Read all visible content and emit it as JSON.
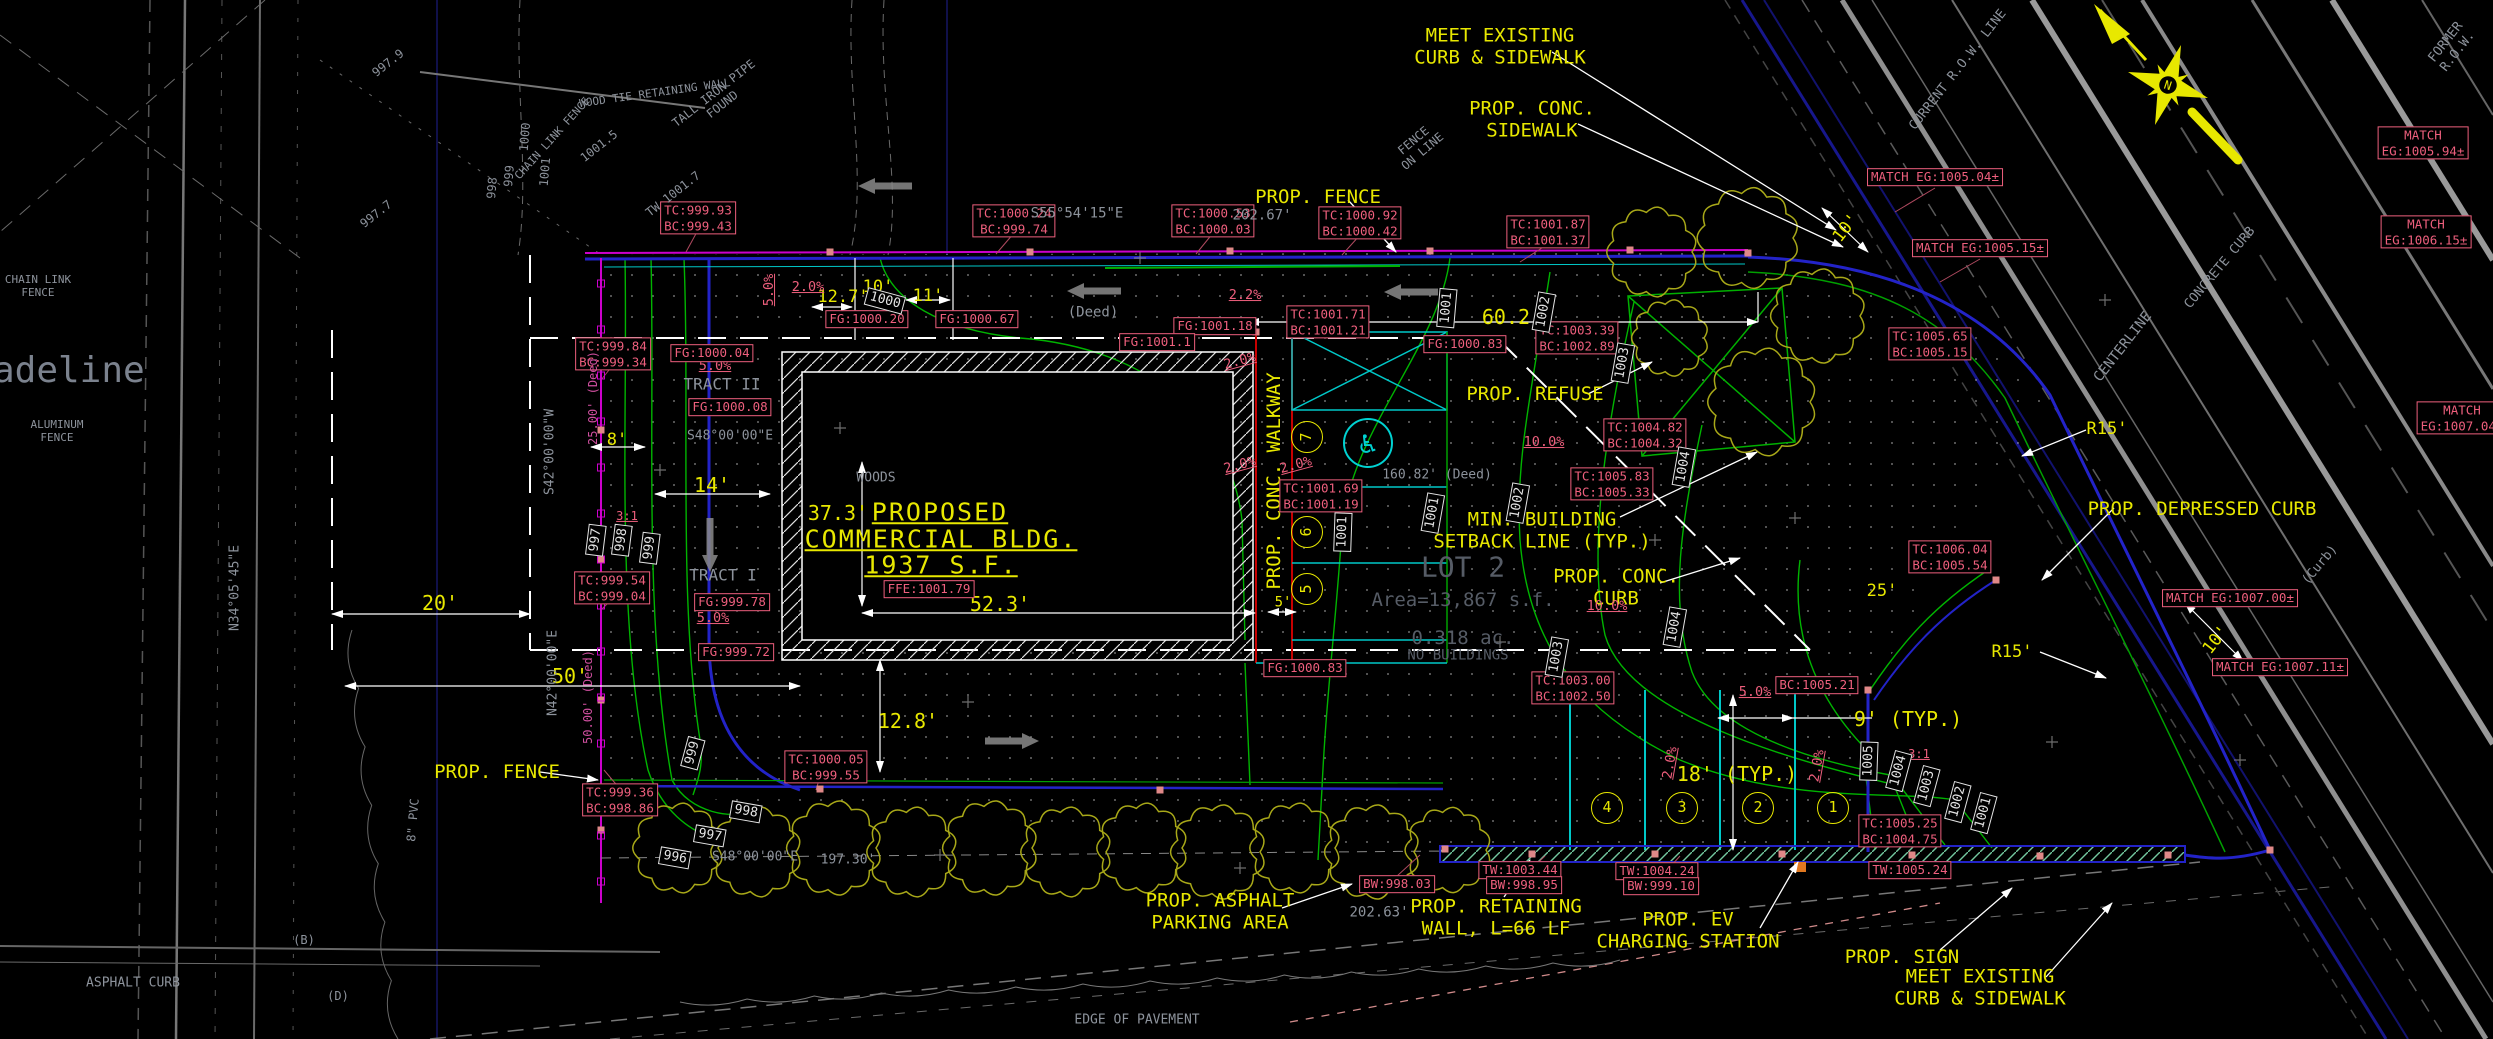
{
  "drawing": {
    "north": {
      "letter": "N"
    },
    "building_text": [
      {
        "t": "PROPOSED",
        "x": 940,
        "y": 512
      },
      {
        "t": "COMMERCIAL BLDG.",
        "x": 941,
        "y": 539
      },
      {
        "t": "1937 S.F.",
        "x": 941,
        "y": 565
      }
    ],
    "callouts": [
      {
        "t": "MEET EXISTING\nCURB & SIDEWALK",
        "x": 1500,
        "y": 47
      },
      {
        "t": "PROP. CONC.\nSIDEWALK",
        "x": 1532,
        "y": 120
      },
      {
        "t": "PROP. FENCE",
        "x": 1318,
        "y": 197
      },
      {
        "t": "PROP. REFUSE",
        "x": 1535,
        "y": 394
      },
      {
        "t": "MIN. BUILDING\nSETBACK LINE (TYP.)",
        "x": 1542,
        "y": 531
      },
      {
        "t": "PROP. CONC.\nCURB",
        "x": 1616,
        "y": 588
      },
      {
        "t": "PROP. DEPRESSED CURB",
        "x": 2202,
        "y": 509
      },
      {
        "t": "PROP. FENCE",
        "x": 497,
        "y": 772
      },
      {
        "t": "PROP. ASPHALT\nPARKING AREA",
        "x": 1220,
        "y": 912
      },
      {
        "t": "PROP. RETAINING\nWALL, L=66 LF",
        "x": 1496,
        "y": 918
      },
      {
        "t": "PROP. EV\nCHARGING STATION",
        "x": 1688,
        "y": 931
      },
      {
        "t": "PROP. SIGN",
        "x": 1902,
        "y": 957
      },
      {
        "t": "MEET EXISTING\nCURB & SIDEWALK",
        "x": 1980,
        "y": 988
      },
      {
        "t": "PROP. CONC. WALKWAY",
        "x": 1274,
        "y": 481,
        "r": -90
      }
    ],
    "dimensions": [
      {
        "t": "12.7'",
        "x": 843,
        "y": 297,
        "s": 17
      },
      {
        "t": "10'",
        "x": 878,
        "y": 287,
        "s": 17
      },
      {
        "t": "11'",
        "x": 928,
        "y": 296,
        "s": 17
      },
      {
        "t": "60.2'",
        "x": 1512,
        "y": 318
      },
      {
        "t": "37.3'",
        "x": 838,
        "y": 514
      },
      {
        "t": "52.3'",
        "x": 1000,
        "y": 605
      },
      {
        "t": "8'",
        "x": 617,
        "y": 440,
        "s": 17
      },
      {
        "t": "14'",
        "x": 712,
        "y": 486
      },
      {
        "t": "20'",
        "x": 440,
        "y": 604
      },
      {
        "t": "50'",
        "x": 570,
        "y": 677
      },
      {
        "t": "12.8'",
        "x": 908,
        "y": 722
      },
      {
        "t": "5'",
        "x": 1283,
        "y": 603,
        "s": 14
      },
      {
        "t": "18' (TYP.)",
        "x": 1737,
        "y": 775
      },
      {
        "t": "9' (TYP.)",
        "x": 1908,
        "y": 720
      },
      {
        "t": "25'",
        "x": 1882,
        "y": 591,
        "s": 17
      },
      {
        "t": "10'",
        "x": 2216,
        "y": 640,
        "r": -52,
        "s": 17
      },
      {
        "t": "10'",
        "x": 1846,
        "y": 228,
        "r": -52,
        "s": 17
      },
      {
        "t": "R15'",
        "x": 2107,
        "y": 429,
        "s": 17
      },
      {
        "t": "R15'",
        "x": 2012,
        "y": 652,
        "s": 17
      }
    ],
    "slopes": [
      {
        "t": "5.0%",
        "x": 770,
        "y": 290,
        "r": -90
      },
      {
        "t": "2.0%",
        "x": 808,
        "y": 288
      },
      {
        "t": "2.2%",
        "x": 1245,
        "y": 296
      },
      {
        "t": "5.0%",
        "x": 715,
        "y": 367
      },
      {
        "t": "5.0%",
        "x": 713,
        "y": 619
      },
      {
        "t": "10.0%",
        "x": 1544,
        "y": 443
      },
      {
        "t": "10.0%",
        "x": 1607,
        "y": 607
      },
      {
        "t": "5.0%",
        "x": 1755,
        "y": 693
      },
      {
        "t": "2.0%",
        "x": 1671,
        "y": 763,
        "r": -80
      },
      {
        "t": "2.0%",
        "x": 1818,
        "y": 766,
        "r": -80
      },
      {
        "t": "2.0%",
        "x": 1240,
        "y": 362,
        "r": -15
      },
      {
        "t": "2.0%",
        "x": 1240,
        "y": 466,
        "r": -15
      },
      {
        "t": "2.0%",
        "x": 1296,
        "y": 466,
        "r": -15
      },
      {
        "t": "3:1",
        "x": 627,
        "y": 516,
        "s": 12
      },
      {
        "t": "3:1",
        "x": 1919,
        "y": 754,
        "s": 12
      }
    ],
    "elevations": [
      {
        "t": "TC:999.93\nBC:999.43",
        "x": 698,
        "y": 218
      },
      {
        "t": "TC:999.84\nBC:999.34",
        "x": 613,
        "y": 354
      },
      {
        "t": "TC:999.54\nBC:999.04",
        "x": 612,
        "y": 588
      },
      {
        "t": "TC:999.36\nBC:998.86",
        "x": 620,
        "y": 800
      },
      {
        "t": "TC:1000.05\nBC:999.55",
        "x": 826,
        "y": 767
      },
      {
        "t": "TC:1000.24\nBC:999.74",
        "x": 1014,
        "y": 221
      },
      {
        "t": "TC:1000.53\nBC:1000.03",
        "x": 1213,
        "y": 221
      },
      {
        "t": "TC:1000.92\nBC:1000.42",
        "x": 1360,
        "y": 223
      },
      {
        "t": "TC:1001.87\nBC:1001.37",
        "x": 1548,
        "y": 232
      },
      {
        "t": "TC:1001.71\nBC:1001.21",
        "x": 1328,
        "y": 322
      },
      {
        "t": "FG:1001.18",
        "x": 1215,
        "y": 326
      },
      {
        "t": "FG:1001.1",
        "x": 1157,
        "y": 342
      },
      {
        "t": "FG:1000.83",
        "x": 1465,
        "y": 344
      },
      {
        "t": "FG:1000.83",
        "x": 1305,
        "y": 668
      },
      {
        "t": "FG:1000.67",
        "x": 977,
        "y": 319
      },
      {
        "t": "FG:1000.20",
        "x": 867,
        "y": 319
      },
      {
        "t": "FG:1000.04",
        "x": 712,
        "y": 353
      },
      {
        "t": "FG:1000.08",
        "x": 730,
        "y": 407
      },
      {
        "t": "FG:999.78",
        "x": 732,
        "y": 602
      },
      {
        "t": "FG:999.72",
        "x": 736,
        "y": 652
      },
      {
        "t": "FFE:1001.79",
        "x": 929,
        "y": 589
      },
      {
        "t": "TC:1003.39\nBC:1002.89",
        "x": 1577,
        "y": 338
      },
      {
        "t": "TC:1004.82\nBC:1004.32",
        "x": 1645,
        "y": 435
      },
      {
        "t": "TC:1005.83\nBC:1005.33",
        "x": 1612,
        "y": 484
      },
      {
        "t": "TC:1003.00\nBC:1002.50",
        "x": 1573,
        "y": 688
      },
      {
        "t": "BC:1005.21",
        "x": 1817,
        "y": 685
      },
      {
        "t": "TC:1005.25\nBC:1004.75",
        "x": 1900,
        "y": 831
      },
      {
        "t": "TC:1006.04\nBC:1005.54",
        "x": 1950,
        "y": 557
      },
      {
        "t": "TC:1001.69\nBC:1001.19",
        "x": 1321,
        "y": 496
      },
      {
        "t": "TW:1003.44",
        "x": 1520,
        "y": 870
      },
      {
        "t": "TW:1004.24",
        "x": 1657,
        "y": 871
      },
      {
        "t": "TW:1005.24",
        "x": 1910,
        "y": 870
      },
      {
        "t": "BW:998.03",
        "x": 1397,
        "y": 884
      },
      {
        "t": "BW:998.95",
        "x": 1524,
        "y": 885
      },
      {
        "t": "BW:999.10",
        "x": 1661,
        "y": 886
      },
      {
        "t": "MATCH EG:1005.04±",
        "x": 1935,
        "y": 177
      },
      {
        "t": "MATCH EG:1005.15±",
        "x": 1980,
        "y": 248
      },
      {
        "t": "TC:1005.65\nBC:1005.15",
        "x": 1930,
        "y": 344
      },
      {
        "t": "MATCH EG:1007.00±",
        "x": 2230,
        "y": 598
      },
      {
        "t": "MATCH EG:1007.11±",
        "x": 2280,
        "y": 667
      },
      {
        "t": "MATCH EG:1005.94±",
        "x": 2423,
        "y": 143
      },
      {
        "t": "MATCH EG:1006.15±",
        "x": 2426,
        "y": 232
      },
      {
        "t": "MATCH EG:1007.04±",
        "x": 2462,
        "y": 418
      }
    ],
    "contour_tags": [
      {
        "t": "997",
        "x": 596,
        "y": 540,
        "r": -83
      },
      {
        "t": "998",
        "x": 622,
        "y": 540,
        "r": -83
      },
      {
        "t": "999",
        "x": 650,
        "y": 548,
        "r": -83
      },
      {
        "t": "1000",
        "x": 885,
        "y": 301,
        "r": 15
      },
      {
        "t": "1001",
        "x": 1447,
        "y": 308,
        "r": -85
      },
      {
        "t": "1002",
        "x": 1544,
        "y": 312,
        "r": -80
      },
      {
        "t": "1003",
        "x": 1623,
        "y": 363,
        "r": -80
      },
      {
        "t": "1004",
        "x": 1684,
        "y": 467,
        "r": -80
      },
      {
        "t": "1001",
        "x": 1433,
        "y": 513,
        "r": -80
      },
      {
        "t": "1002",
        "x": 1518,
        "y": 503,
        "r": -80
      },
      {
        "t": "1003",
        "x": 1557,
        "y": 657,
        "r": -80
      },
      {
        "t": "1004",
        "x": 1675,
        "y": 627,
        "r": -80
      },
      {
        "t": "1001",
        "x": 1343,
        "y": 532,
        "r": -88
      },
      {
        "t": "1005",
        "x": 1869,
        "y": 761,
        "r": -88
      },
      {
        "t": "1004",
        "x": 1899,
        "y": 771,
        "r": -75
      },
      {
        "t": "1003",
        "x": 1927,
        "y": 786,
        "r": -75
      },
      {
        "t": "1002",
        "x": 1958,
        "y": 802,
        "r": -75
      },
      {
        "t": "1001",
        "x": 1984,
        "y": 813,
        "r": -75
      },
      {
        "t": "999",
        "x": 693,
        "y": 753,
        "r": -75
      },
      {
        "t": "998",
        "x": 746,
        "y": 812,
        "r": 10
      },
      {
        "t": "997",
        "x": 710,
        "y": 836,
        "r": 10
      },
      {
        "t": "996",
        "x": 675,
        "y": 858,
        "r": 10
      }
    ],
    "gray_notes": [
      {
        "t": "madeline",
        "x": 58,
        "y": 371,
        "s": 36,
        "c": "#7b828e"
      },
      {
        "t": "ALUMINUM\nFENCE",
        "x": 57,
        "y": 432,
        "s": 11
      },
      {
        "t": "ASPHALT CURB",
        "x": 133,
        "y": 983
      },
      {
        "t": "EDGE OF PAVEMENT",
        "x": 1137,
        "y": 1020
      },
      {
        "t": "WOODS",
        "x": 876,
        "y": 478
      },
      {
        "t": "TRACT II",
        "x": 722,
        "y": 385,
        "s": 16
      },
      {
        "t": "TRACT I",
        "x": 723,
        "y": 576,
        "s": 16
      },
      {
        "t": "LOT 2",
        "x": 1463,
        "y": 567,
        "s": 28,
        "c": "#565c66"
      },
      {
        "t": "Area=13,867 s.f.",
        "x": 1463,
        "y": 600,
        "s": 19,
        "c": "#565c66"
      },
      {
        "t": "0.318 ac.",
        "x": 1463,
        "y": 638,
        "s": 19,
        "c": "#565c66"
      },
      {
        "t": "NO BUILDINGS",
        "x": 1458,
        "y": 656,
        "s": 14,
        "c": "#565c66"
      },
      {
        "t": "(Deed)",
        "x": 1093,
        "y": 313,
        "s": 14
      },
      {
        "t": "202.67'",
        "x": 1262,
        "y": 216,
        "s": 14
      },
      {
        "t": "S55°54'15\"E",
        "x": 1077,
        "y": 214,
        "s": 14
      },
      {
        "t": "S42°00'00\"W",
        "x": 550,
        "y": 452,
        "r": -90
      },
      {
        "t": "N34°05'45\"E",
        "x": 235,
        "y": 588,
        "r": -90
      },
      {
        "t": "N42°00'00\"E",
        "x": 553,
        "y": 673,
        "r": -90
      },
      {
        "t": "S48°00'00\"E",
        "x": 730,
        "y": 436
      },
      {
        "t": "160.82' (Deed)",
        "x": 1437,
        "y": 475
      },
      {
        "t": "S48°00'00\"E",
        "x": 755,
        "y": 857
      },
      {
        "t": "197.30'",
        "x": 848,
        "y": 860
      },
      {
        "t": "202.63'",
        "x": 1379,
        "y": 913,
        "s": 14
      },
      {
        "t": "CENTERLINE",
        "x": 2123,
        "y": 347,
        "r": -52,
        "s": 14
      },
      {
        "t": "CONCRETE CURB",
        "x": 2220,
        "y": 268,
        "r": -50
      },
      {
        "t": "(Curb)",
        "x": 2320,
        "y": 565,
        "r": -50
      },
      {
        "t": "CURRENT R.O.W. LINE",
        "x": 1958,
        "y": 70,
        "r": -52
      },
      {
        "t": "FORMER R.O.W.",
        "x": 2452,
        "y": 47,
        "r": -52
      },
      {
        "t": "FENCE\nON LINE",
        "x": 1418,
        "y": 146,
        "r": -40,
        "s": 12
      },
      {
        "t": "TALL IRON PIPE\nFOUND",
        "x": 718,
        "y": 99,
        "r": -38,
        "s": 12
      },
      {
        "t": "WOOD TIE RETAINING WALL",
        "x": 655,
        "y": 94,
        "r": -8,
        "s": 11
      },
      {
        "t": "CHAIN LINK FENCE",
        "x": 553,
        "y": 139,
        "r": -48,
        "s": 11
      },
      {
        "t": "CHAIN LINK\nFENCE",
        "x": 38,
        "y": 287,
        "s": 11
      },
      {
        "t": "8\" PVC",
        "x": 413,
        "y": 820,
        "r": -85,
        "s": 12
      },
      {
        "t": "TW 1001.7",
        "x": 673,
        "y": 194,
        "r": -38,
        "s": 12
      },
      {
        "t": "997.9",
        "x": 388,
        "y": 63,
        "r": -38,
        "s": 12
      },
      {
        "t": "997.7",
        "x": 376,
        "y": 214,
        "r": -38,
        "s": 12
      },
      {
        "t": "1001.5",
        "x": 599,
        "y": 146,
        "r": -38,
        "s": 12
      },
      {
        "t": "998",
        "x": 492,
        "y": 188,
        "r": -85,
        "s": 12
      },
      {
        "t": "999",
        "x": 509,
        "y": 176,
        "r": -85,
        "s": 12
      },
      {
        "t": "1000",
        "x": 525,
        "y": 137,
        "r": -85,
        "s": 12
      },
      {
        "t": "1001",
        "x": 545,
        "y": 172,
        "r": -85,
        "s": 12
      },
      {
        "t": "(B)",
        "x": 304,
        "y": 940,
        "s": 12
      },
      {
        "t": "(D)",
        "x": 338,
        "y": 996,
        "s": 12
      },
      {
        "t": "50.00' (Deed)",
        "x": 588,
        "y": 697,
        "r": -90,
        "s": 12,
        "c": "#cf4f9f"
      },
      {
        "t": "25.00' (Deed)",
        "x": 593,
        "y": 398,
        "r": -90,
        "s": 12,
        "c": "#cf4f9f"
      }
    ],
    "parking_numbers": [
      {
        "t": "4",
        "x": 1607,
        "y": 808
      },
      {
        "t": "3",
        "x": 1682,
        "y": 808
      },
      {
        "t": "2",
        "x": 1758,
        "y": 808
      },
      {
        "t": "1",
        "x": 1833,
        "y": 808
      },
      {
        "t": "7",
        "x": 1307,
        "y": 437,
        "r": -90
      },
      {
        "t": "6",
        "x": 1307,
        "y": 532,
        "r": -90
      },
      {
        "t": "5",
        "x": 1307,
        "y": 589,
        "r": -90
      }
    ],
    "handicap": {
      "symbol": "♿",
      "x": 1368,
      "y": 443
    },
    "colors": {
      "annotation_yellow": "#e8e800",
      "elevation_pink": "#ee5f7d",
      "contour_green": "#00b400",
      "curb_blue": "#2323c8",
      "stall_cyan": "#00c8c8",
      "fence_magenta": "#cc00cc",
      "existing_gray": "#8d939c"
    }
  }
}
